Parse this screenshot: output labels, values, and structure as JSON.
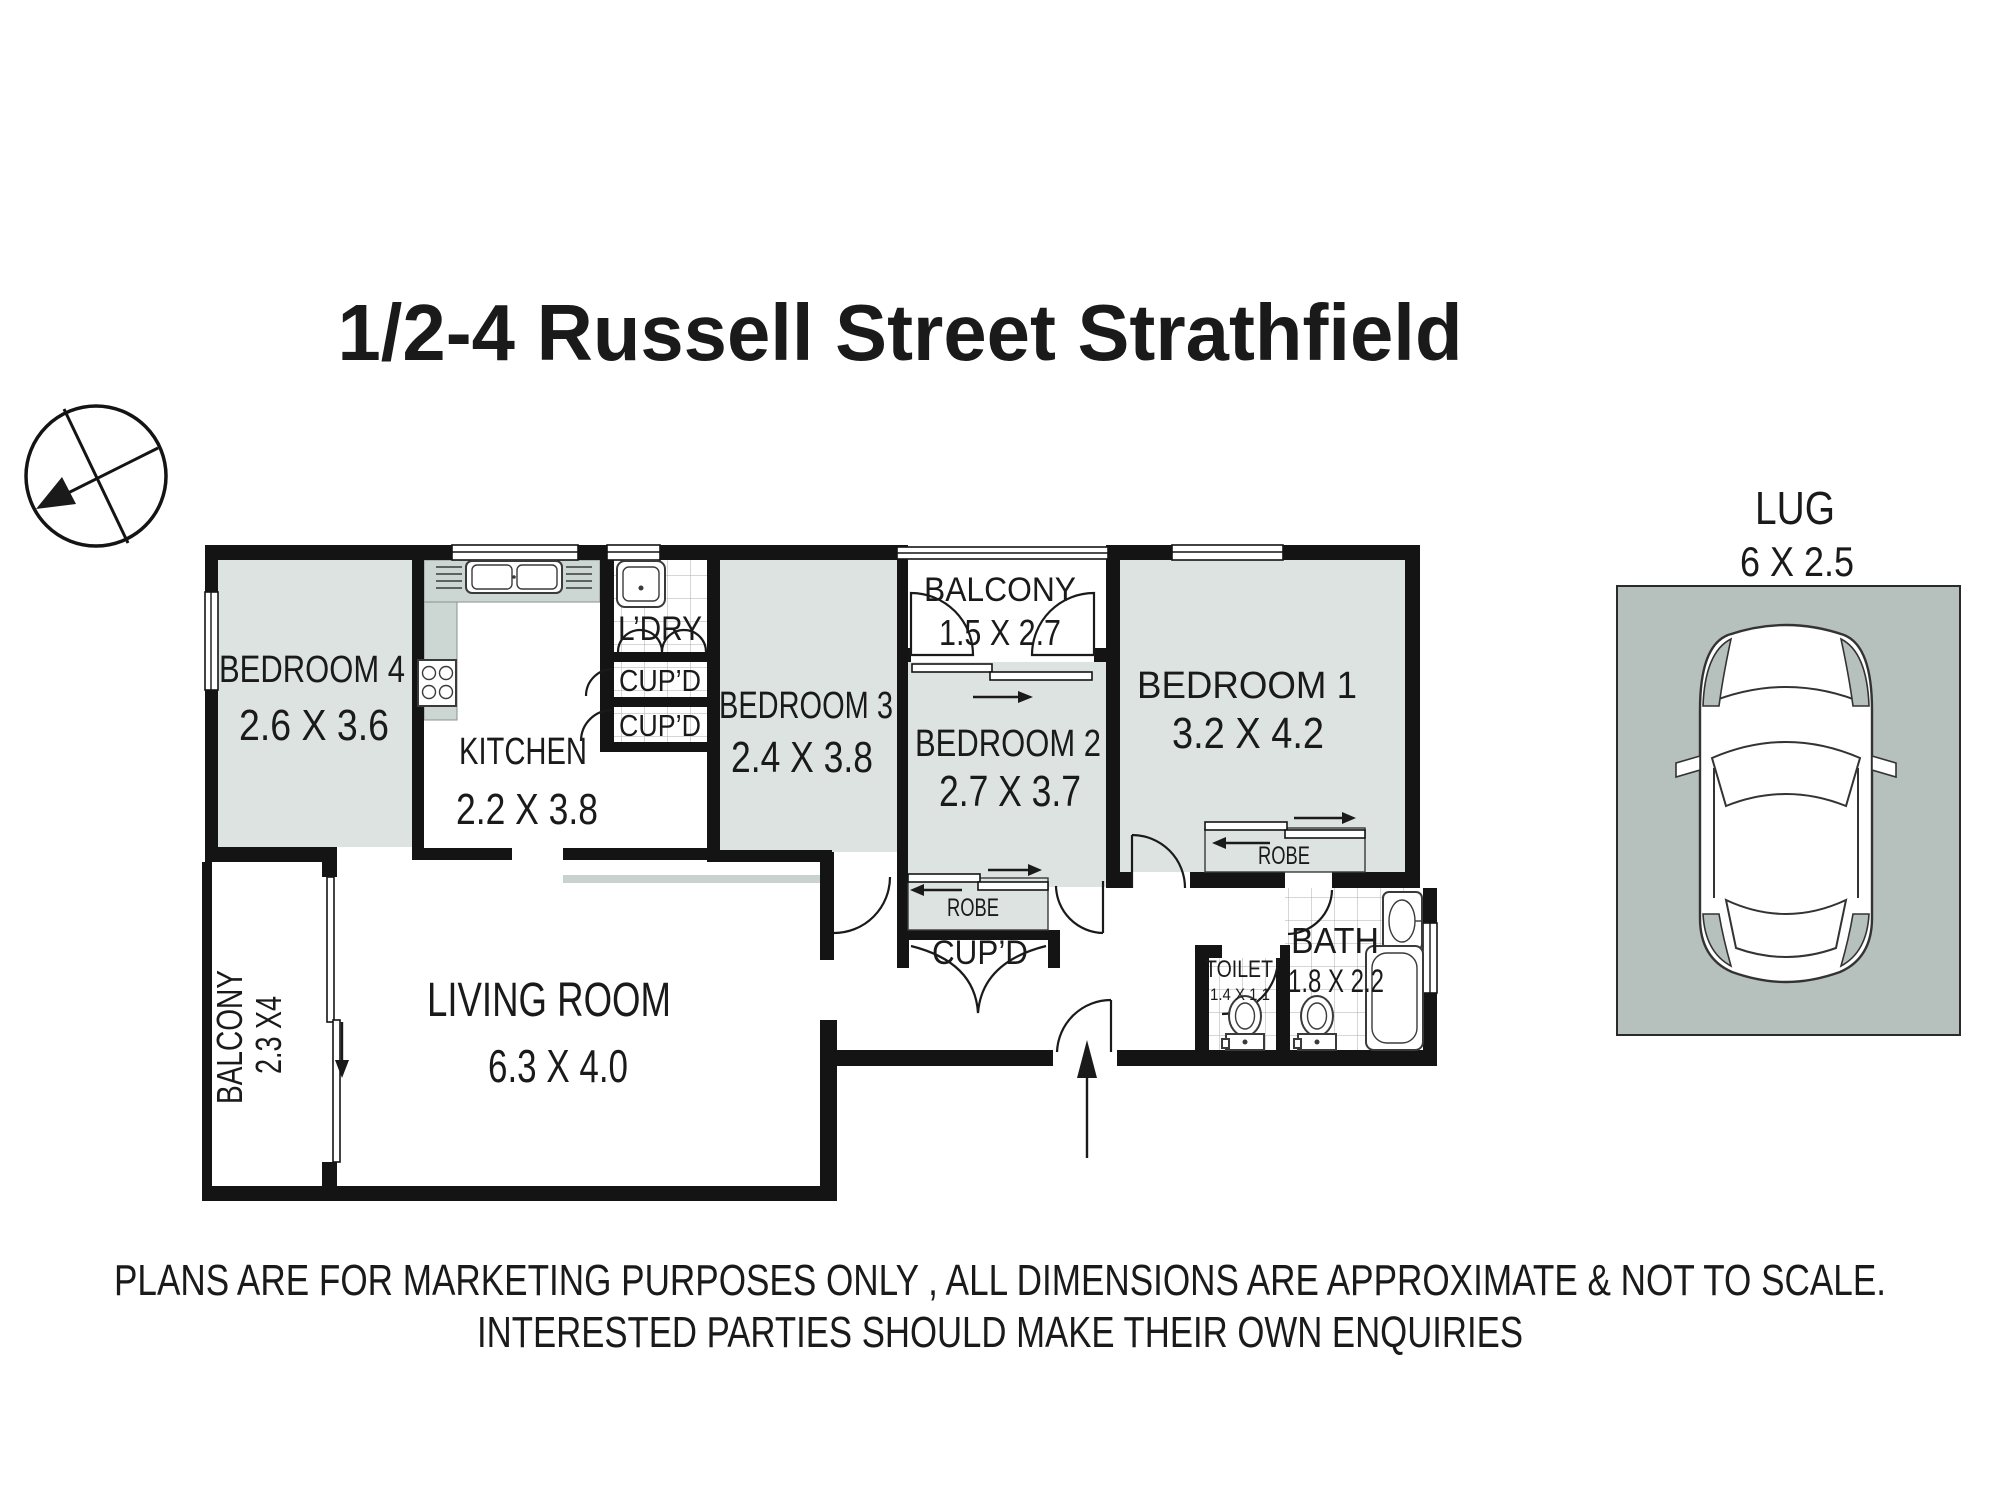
{
  "title": "1/2-4 Russell Street Strathfield",
  "floorplan": {
    "rooms": [
      {
        "id": "bedroom4",
        "name": "BEDROOM 4",
        "dims": "2.6 X 3.6"
      },
      {
        "id": "kitchen",
        "name": "KITCHEN",
        "dims": "2.2 X 3.8"
      },
      {
        "id": "laundry",
        "name": "L’DRY",
        "dims": ""
      },
      {
        "id": "cupboard1",
        "name": "CUP’D",
        "dims": ""
      },
      {
        "id": "cupboard2",
        "name": "CUP’D",
        "dims": ""
      },
      {
        "id": "bedroom3",
        "name": "BEDROOM 3",
        "dims": "2.4 X 3.8"
      },
      {
        "id": "balcony-top",
        "name": "BALCONY",
        "dims": "1.5 X 2.7"
      },
      {
        "id": "bedroom2",
        "name": "BEDROOM 2",
        "dims": "2.7 X 3.7"
      },
      {
        "id": "bedroom1",
        "name": "BEDROOM 1",
        "dims": "3.2 X 4.2"
      },
      {
        "id": "living-room",
        "name": "LIVING ROOM",
        "dims": "6.3 X 4.0"
      },
      {
        "id": "balcony-side",
        "name": "BALCONY",
        "dims": "2.3 X4"
      },
      {
        "id": "toilet",
        "name": "TOILET",
        "dims": "1.4 X 1.1"
      },
      {
        "id": "bath",
        "name": "BATH",
        "dims": "1.8 X 2.2"
      },
      {
        "id": "robe-bedroom2",
        "name": "ROBE",
        "dims": ""
      },
      {
        "id": "robe-bedroom1",
        "name": "ROBE",
        "dims": ""
      },
      {
        "id": "cupboard-hall",
        "name": "CUP’D",
        "dims": ""
      }
    ],
    "garage": {
      "name": "LUG",
      "dims": "6 X 2.5"
    }
  },
  "disclaimer": {
    "line1": "PLANS ARE FOR MARKETING PURPOSES ONLY , ALL DIMENSIONS ARE APPROXIMATE & NOT TO SCALE.",
    "line2": "INTERESTED PARTIES SHOULD MAKE THEIR OWN ENQUIRIES"
  },
  "colors": {
    "room_fill": "#dde3e1",
    "counter_fill": "#ccd6d2",
    "garage_fill": "#b6c1be",
    "wall": "#141414",
    "text": "#1a1a1a"
  }
}
